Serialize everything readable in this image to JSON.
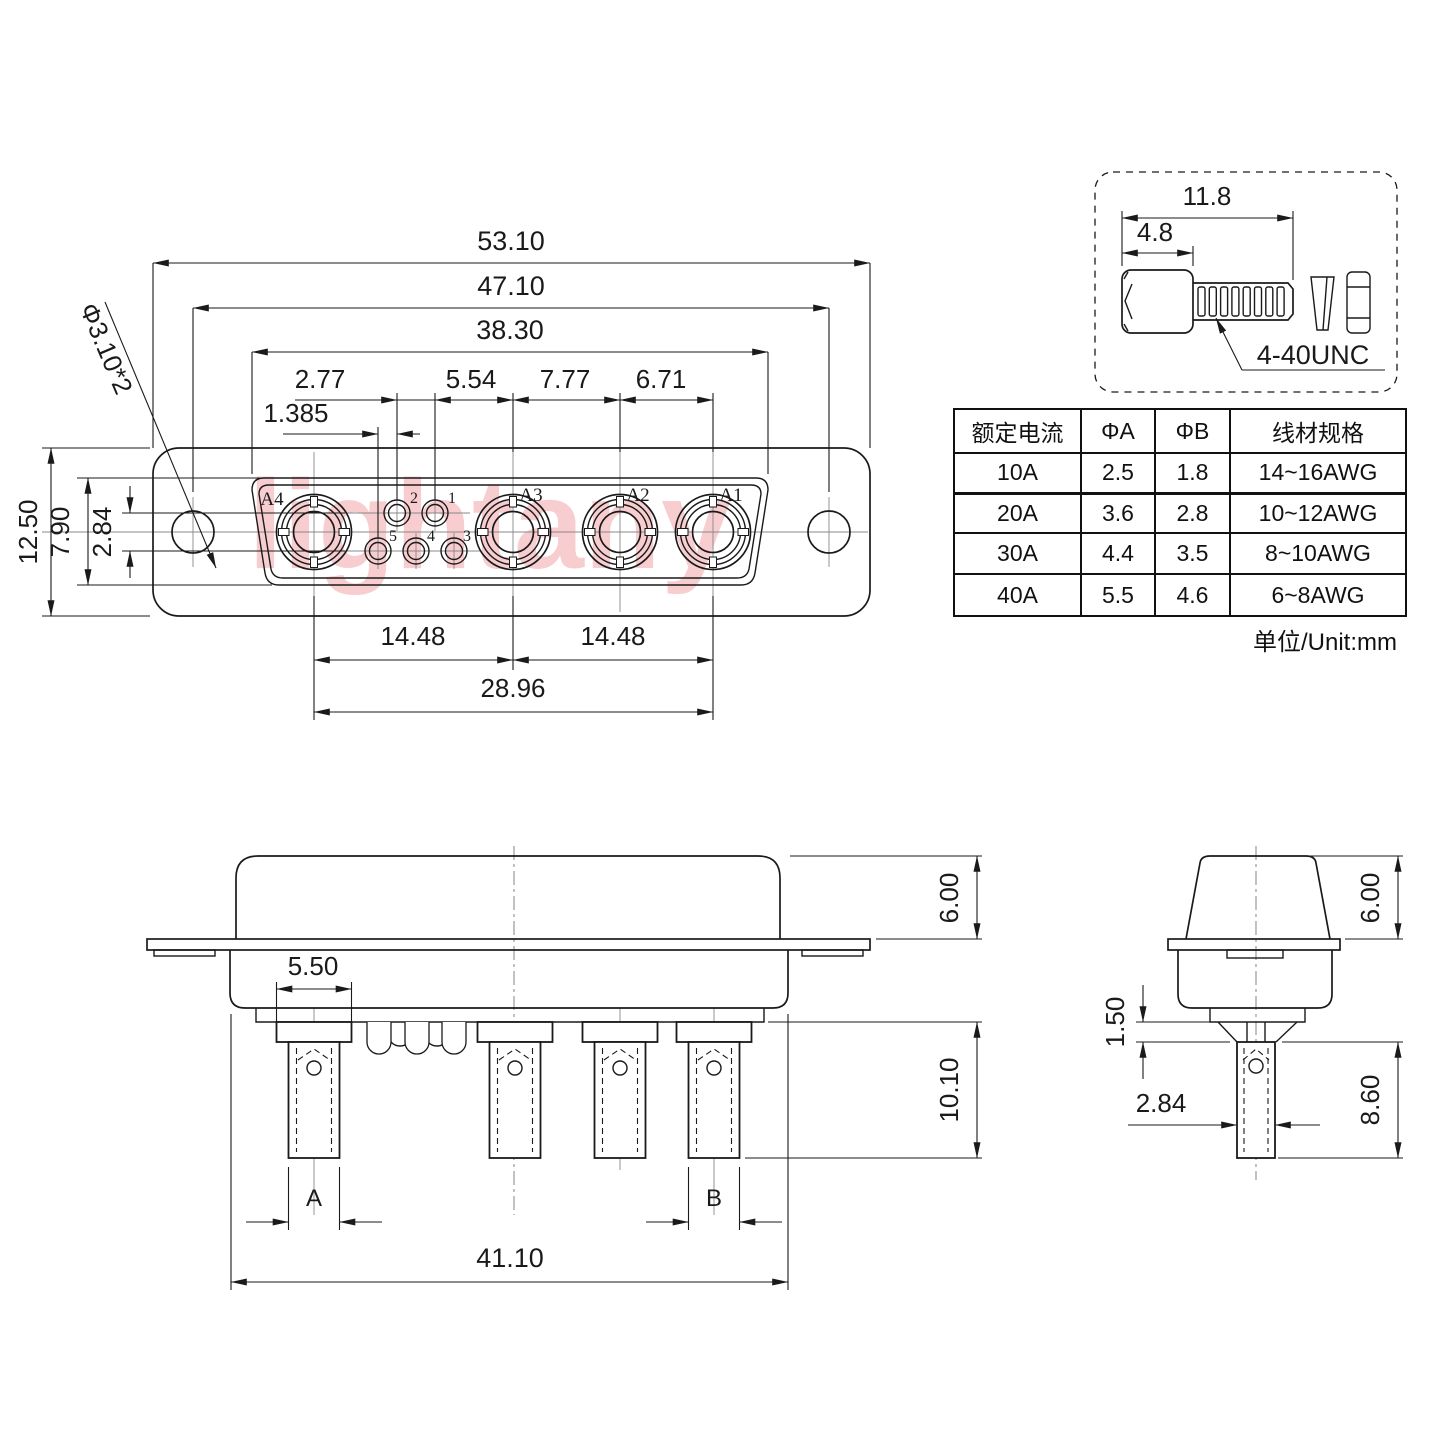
{
  "watermark": "lightany",
  "front_view": {
    "dim_53_10": "53.10",
    "dim_47_10": "47.10",
    "dim_38_30": "38.30",
    "dim_2_77": "2.77",
    "dim_5_54": "5.54",
    "dim_7_77": "7.77",
    "dim_6_71": "6.71",
    "dim_1_385": "1.385",
    "dim_12_50": "12.50",
    "dim_7_90": "7.90",
    "dim_2_84": "2.84",
    "hole_note": "Φ3.10*2",
    "dim_14_48_left": "14.48",
    "dim_14_48_right": "14.48",
    "dim_28_96": "28.96",
    "contacts": [
      "A4",
      "A3",
      "A2",
      "A1"
    ],
    "pins": [
      "2",
      "1",
      "5",
      "4",
      "3"
    ]
  },
  "screw_detail": {
    "dim_length": "11.8",
    "dim_head": "4.8",
    "thread_label": "4-40UNC"
  },
  "spec_table": {
    "headers": [
      "额定电流",
      "ΦA",
      "ΦB",
      "线材规格"
    ],
    "rows": [
      [
        "10A",
        "2.5",
        "1.8",
        "14~16AWG"
      ],
      [
        "20A",
        "3.6",
        "2.8",
        "10~12AWG"
      ],
      [
        "30A",
        "4.4",
        "3.5",
        "8~10AWG"
      ],
      [
        "40A",
        "5.5",
        "4.6",
        "6~8AWG"
      ]
    ],
    "unit_note": "单位/Unit:mm"
  },
  "side_view": {
    "dim_6_00": "6.00",
    "dim_5_50": "5.50",
    "dim_10_10": "10.10",
    "dim_41_10": "41.10",
    "label_a": "A",
    "label_b": "B"
  },
  "end_view": {
    "dim_6_00": "6.00",
    "dim_1_50": "1.50",
    "dim_2_84": "2.84",
    "dim_8_60": "8.60"
  }
}
